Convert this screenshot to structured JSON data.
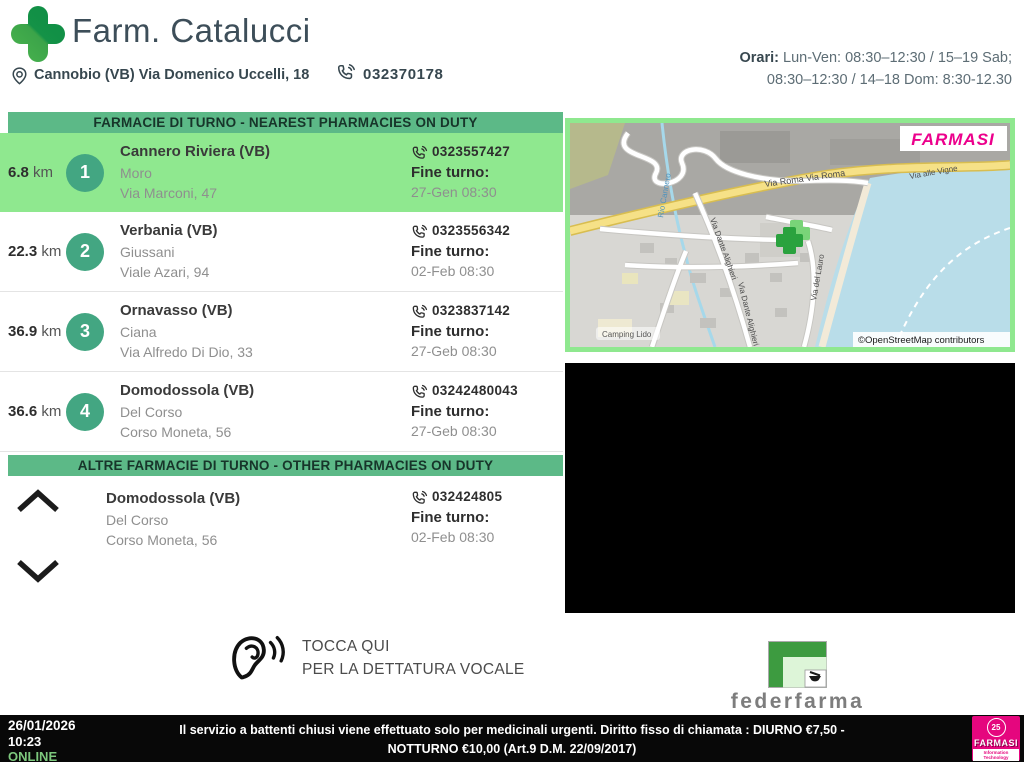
{
  "header": {
    "pharmacy_name": "Farm. Catalucci",
    "address": "Cannobio (VB) Via Domenico Uccelli, 18",
    "phone": "032370178",
    "hours_label": "Orari:",
    "hours_line1": "Lun-Ven: 08:30–12:30 / 15–19 Sab;",
    "hours_line2": "08:30–12:30 / 14–18 Dom: 8:30-12.30"
  },
  "sections": {
    "nearest_title": "FARMACIE DI TURNO - NEAREST PHARMACIES ON DUTY",
    "other_title": "ALTRE FARMACIE DI TURNO - OTHER PHARMACIES ON DUTY"
  },
  "fine_turno_label": "Fine turno:",
  "km_unit": "km",
  "pharmacies": [
    {
      "distance": "6.8",
      "number": "1",
      "city": "Cannero Riviera (VB)",
      "name": "Moro",
      "address": "Via Marconi, 47",
      "phone": "0323557427",
      "fine_turno": "27-Gen 08:30"
    },
    {
      "distance": "22.3",
      "number": "2",
      "city": "Verbania (VB)",
      "name": "Giussani",
      "address": "Viale Azari, 94",
      "phone": "0323556342",
      "fine_turno": "02-Feb 08:30"
    },
    {
      "distance": "36.9",
      "number": "3",
      "city": "Ornavasso (VB)",
      "name": "Ciana",
      "address": "Via Alfredo Di Dio, 33",
      "phone": "0323837142",
      "fine_turno": "27-Geb 08:30"
    },
    {
      "distance": "36.6",
      "number": "4",
      "city": "Domodossola (VB)",
      "name": "Del Corso",
      "address": "Corso Moneta, 56",
      "phone": "03242480043",
      "fine_turno": "27-Geb 08:30"
    }
  ],
  "other_pharmacy": {
    "city": "Domodossola (VB)",
    "name": "Del Corso",
    "address": "Corso Moneta, 56",
    "phone": "032424805",
    "fine_turno": "02-Feb 08:30"
  },
  "map": {
    "watermark": "FARMASI",
    "attribution": "©OpenStreetMap contributors",
    "labels": {
      "road1": "Via Roma Via Roma",
      "road2": "Via alle Vigne",
      "road3": "Via Dante Alighieri",
      "road4": "Via Dante Alighieri",
      "road5": "Via del Lauro",
      "river": "Rio Cannero",
      "poi": "Camping Lido"
    }
  },
  "voice": {
    "line1": "TOCCA QUI",
    "line2": "PER LA DETTATURA VOCALE"
  },
  "federfarma_label": "federfarma",
  "footer": {
    "date": "26/01/2026",
    "time": "10:23",
    "status": "ONLINE",
    "message": "Il servizio a battenti chiusi viene effettuato solo per medicinali urgenti. Diritto fisso di chiamata : DIURNO €7,50 - NOTTURNO €10,00 (Art.9 D.M. 22/09/2017)",
    "logo": {
      "badge": "25",
      "name": "FARMASI",
      "subtitle": "Information Technology"
    }
  },
  "colors": {
    "accent_green": "#5cb987",
    "highlight_green": "#8fe88f",
    "circle_green": "#43a682",
    "brand_magenta": "#e5067e",
    "online_green": "#7dc87d"
  }
}
